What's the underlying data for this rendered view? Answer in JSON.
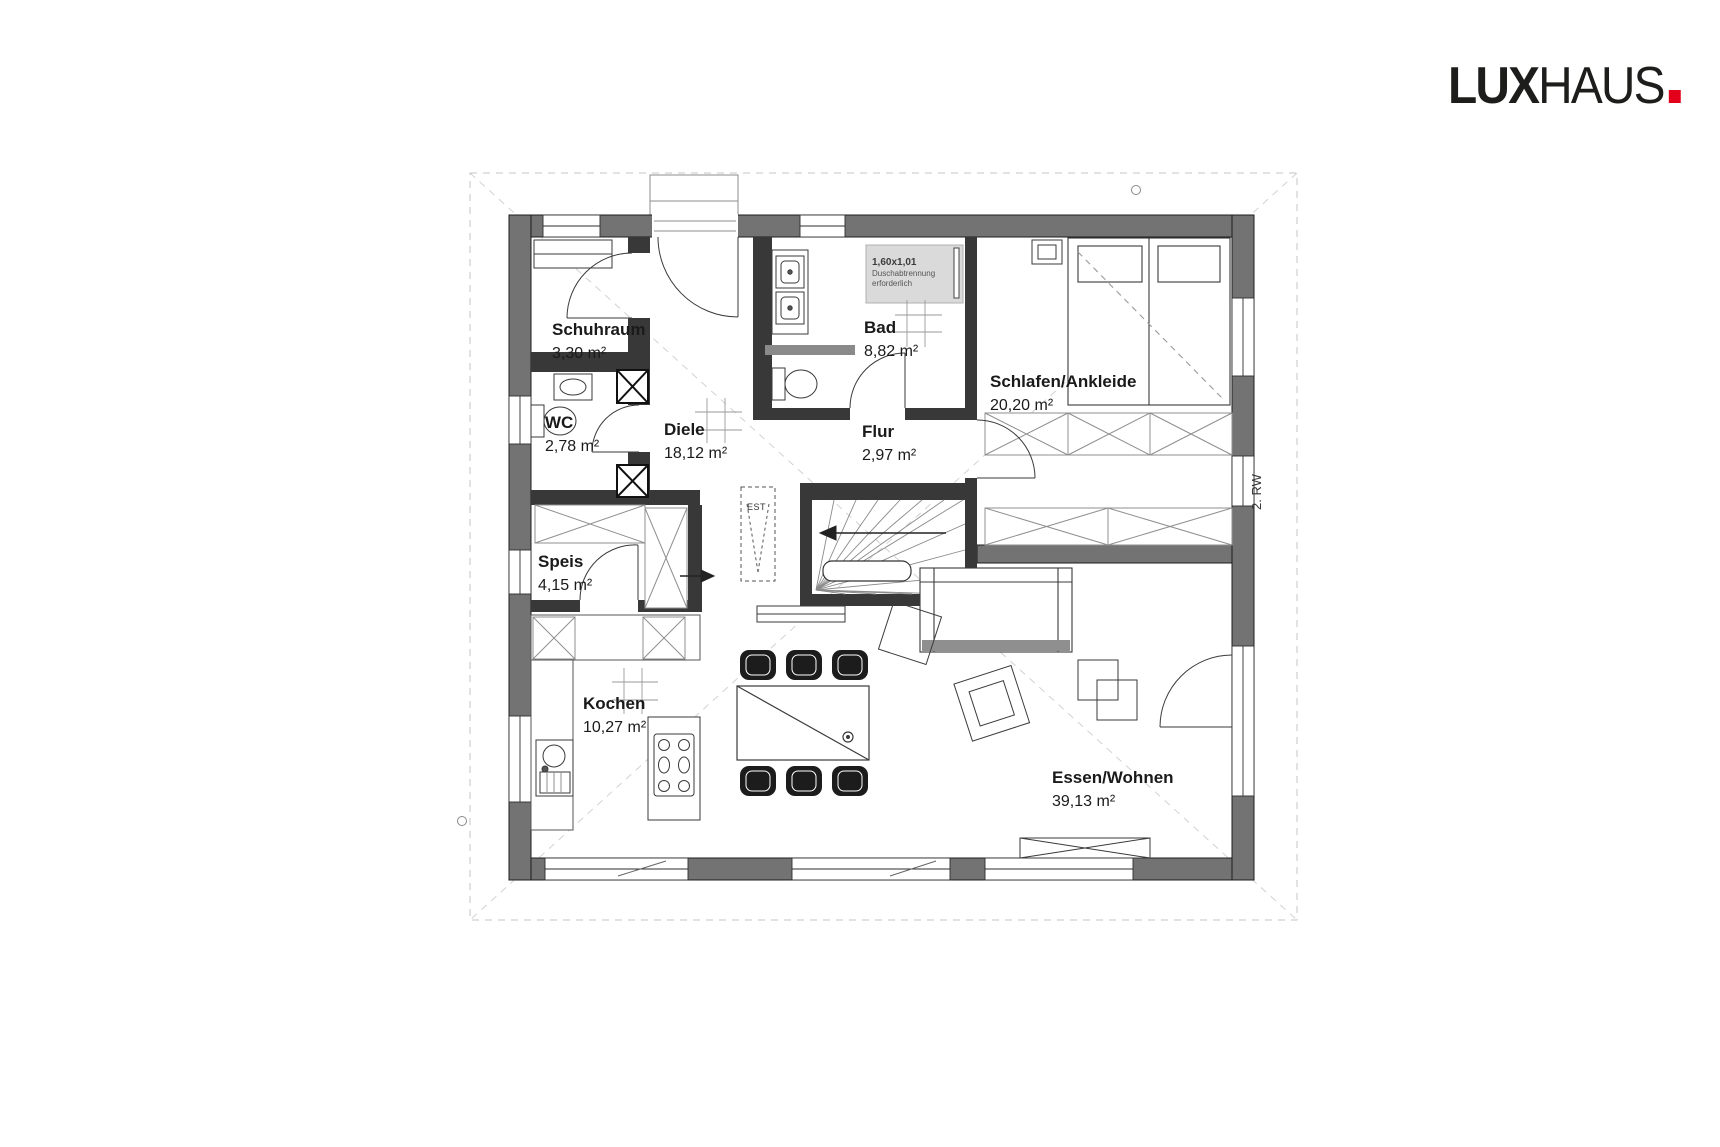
{
  "logo": {
    "lux": "LUX",
    "haus": "HAUS",
    "dot_color": "#e2001a",
    "text_color": "#1d1d1b"
  },
  "plan": {
    "escape_route_label": "2. RW",
    "est_label": "EST",
    "shower_note": {
      "line1": "1,60x1,01",
      "line2": "Duschabtrennung",
      "line3": "erforderlich"
    },
    "rooms": [
      {
        "id": "schuhraum",
        "name": "Schuhraum",
        "area": "3,30 m²"
      },
      {
        "id": "wc",
        "name": "WC",
        "area": "2,78 m²"
      },
      {
        "id": "diele",
        "name": "Diele",
        "area": "18,12 m²"
      },
      {
        "id": "bad",
        "name": "Bad",
        "area": "8,82 m²"
      },
      {
        "id": "flur",
        "name": "Flur",
        "area": "2,97 m²"
      },
      {
        "id": "schlafen",
        "name": "Schlafen/Ankleide",
        "area": "20,20 m²"
      },
      {
        "id": "speis",
        "name": "Speis",
        "area": "4,15 m²"
      },
      {
        "id": "kochen",
        "name": "Kochen",
        "area": "10,27 m²"
      },
      {
        "id": "essen",
        "name": "Essen/Wohnen",
        "area": "39,13 m²"
      }
    ],
    "colors": {
      "exterior_wall": "#737373",
      "interior_wall": "#383838",
      "shower_fill": "#dadada",
      "dashed_line": "#c6c6c6"
    }
  }
}
